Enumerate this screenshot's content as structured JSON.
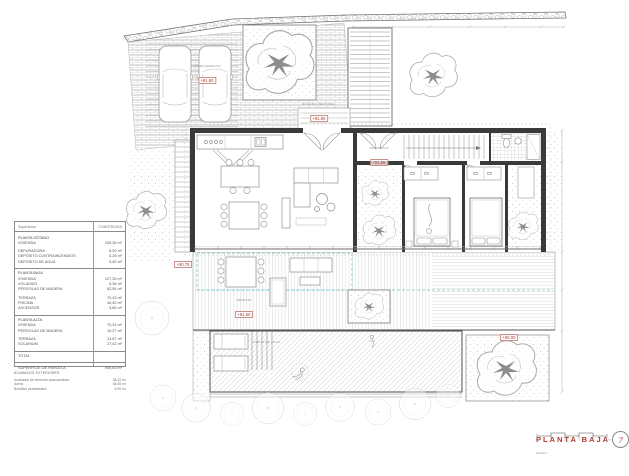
{
  "sheet": {
    "name": "PLANTA BAJA"
  },
  "area_table": {
    "header": {
      "left": "Superficies",
      "right": "CONSTRUIDA"
    },
    "rows": [
      {
        "l": "PLANTA SÓTANO",
        "v": ""
      },
      {
        "l": "VIVIENDA",
        "v": "105,35 m²"
      },
      {
        "l": "DEPURADORA",
        "v": "6,00 m²"
      },
      {
        "l": "DEPÓSITO CONTRAINCENDIOS",
        "v": "5,28 m²"
      },
      {
        "l": "DEPÓSITO DE AGUA",
        "v": "9,40 m²"
      },
      {
        "l": "PLANTA BAJA",
        "v": ""
      },
      {
        "l": "VIVIENDA",
        "v": "127,39 m²"
      },
      {
        "l": "VOLADIZO",
        "v": "5,36 m²"
      },
      {
        "l": "PÉRGOLAS DE MADERA",
        "v": "62,54 m²"
      },
      {
        "l": "TERRAZA",
        "v": "70,43 m²"
      },
      {
        "l": "PISCINA",
        "v": "40,40 m²"
      },
      {
        "l": "ASCENSOR",
        "v": "5,85 m²"
      },
      {
        "l": "PLANTA ALTA",
        "v": ""
      },
      {
        "l": "VIVIENDA",
        "v": "70,24 m²"
      },
      {
        "l": "PÉRGOLAS DE MADERA",
        "v": "19,27 m²"
      },
      {
        "l": "TERRAZA",
        "v": "13,67 m²"
      },
      {
        "l": "SOLARIUM",
        "v": "27,02 m²"
      },
      {
        "l": "TOTAL",
        "v": ""
      },
      {
        "l": "SUPERFICIE DE PARCELA",
        "v": "900,00 m²"
      }
    ]
  },
  "finishes": {
    "title": "ACABADOS EXTERIORES",
    "rows": [
      {
        "l": "Acabados de cemento aparcamiento",
        "v": "38,42 m²"
      },
      {
        "l": "Acera",
        "v": "34,65 m²"
      },
      {
        "l": "Bordillos perimetrales",
        "v": "9,90 m²"
      }
    ]
  },
  "levels": {
    "carport": {
      "label": "APARCAMIENTO",
      "value": "+81.80"
    },
    "entrance": {
      "label": "ACCESO PEATONAL",
      "value": "+81.80"
    },
    "hall": {
      "label": "VESTÍBULO",
      "value": "+81.65"
    },
    "west": {
      "label": "",
      "value": "+80.75"
    },
    "terrace": {
      "label": "TERRAZA",
      "value": "+81.50"
    },
    "garden": {
      "label": "",
      "value": "+80.05"
    },
    "pool": {
      "label": "LÁMINA DE AGUA",
      "value": ""
    }
  },
  "title_block": {
    "title": "PLANTA BAJA",
    "logo": "7",
    "scale_label": "ESCALA",
    "scale_marks": [
      "0",
      "1",
      "2",
      "3",
      "4",
      "5 m"
    ]
  },
  "palette": {
    "accent_red": "#b0362c",
    "pergola_teal": "#73c6c6",
    "line_gray": "#9a9a9a"
  }
}
